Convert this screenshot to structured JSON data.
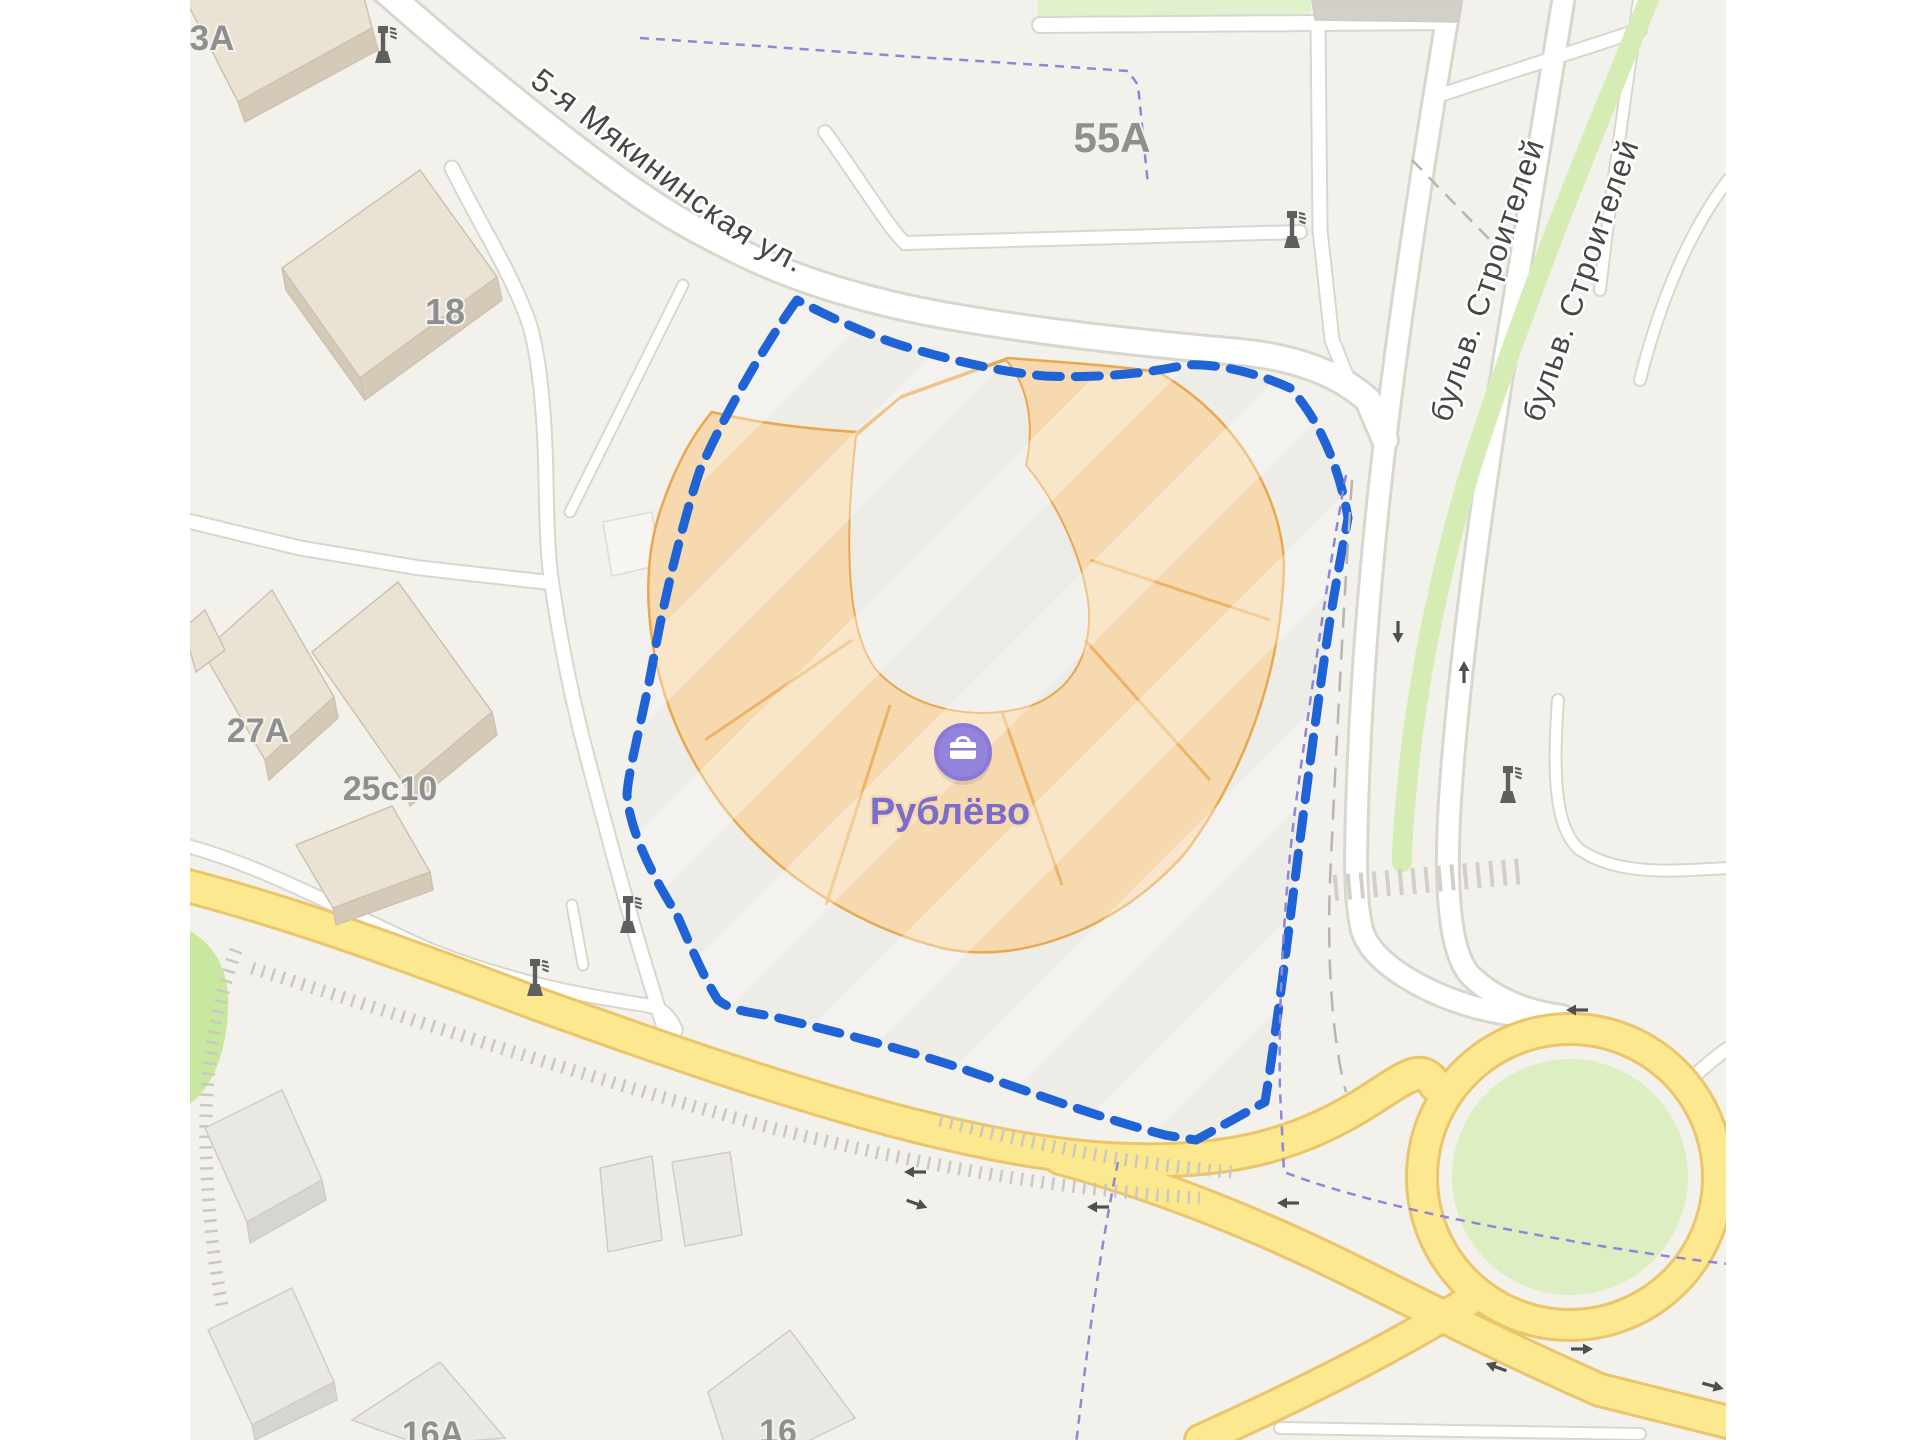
{
  "map": {
    "poi": {
      "label": "Рублёво"
    },
    "streets": {
      "myakininskaya": "5-я Мякининская ул.",
      "stroiteley_west": "бульв. Строителей",
      "stroiteley_east": "бульв. Строителей"
    },
    "buildings": {
      "b3a": "3А",
      "b18": "18",
      "b55a": "55А",
      "b27a": "27А",
      "b25c10": "25с10",
      "b16a": "16А",
      "b16": "16"
    },
    "colors": {
      "selection_outline": "#1f63d6",
      "admin_boundary": "#8f86db",
      "poi_accent": "#7b6dcb",
      "highlight_building": "#f6d9ae",
      "major_road": "#fce88f",
      "greenery": "#d5edb5",
      "map_background": "#f3f1ec"
    },
    "icons": {
      "street_lamp": "street-lamp",
      "direction_arrow": "direction-arrow",
      "poi_glyph": "briefcase"
    }
  }
}
